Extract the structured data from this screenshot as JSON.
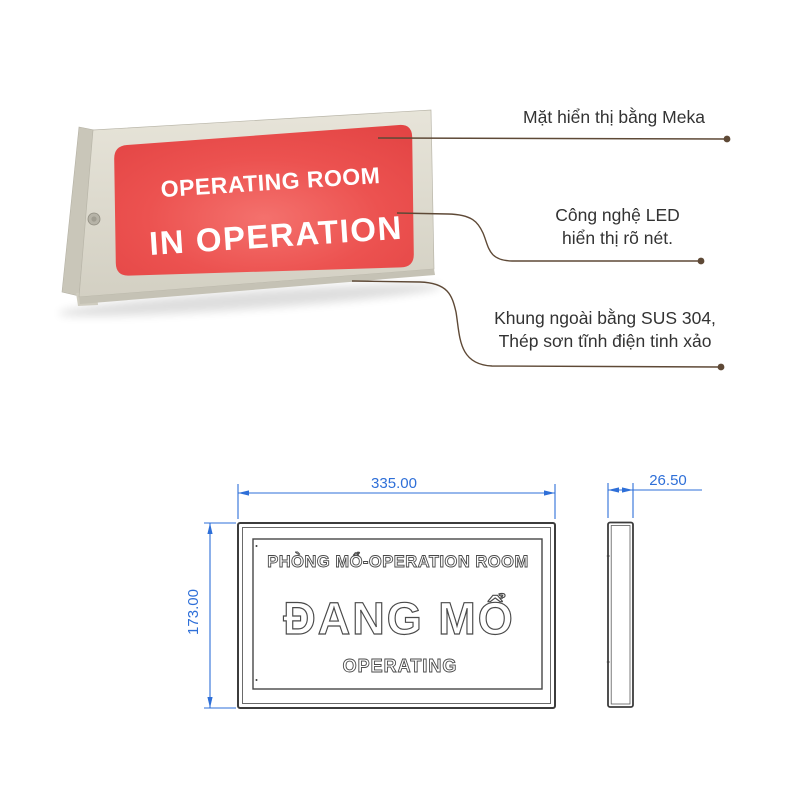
{
  "sign": {
    "display_line1": "OPERATING ROOM",
    "display_line2": "IN OPERATION",
    "colors": {
      "display_red": "#e94b4b",
      "frame_beige": "#dbd7ca",
      "sign_text": "#ffffff",
      "leader_brown": "#5e4936"
    }
  },
  "annotations": [
    {
      "lines": [
        "Mặt hiển thị bằng Meka"
      ]
    },
    {
      "lines": [
        "Công nghệ LED",
        "hiển thị rõ nét."
      ]
    },
    {
      "lines": [
        "Khung ngoài bằng SUS 304,",
        "Thép sơn tĩnh điện tinh xảo"
      ]
    }
  ],
  "drawing": {
    "front_view": {
      "text_top": "PHÒNG MỔ-OPERATION ROOM",
      "text_main": "ĐANG MỔ",
      "text_bottom": "OPERATING",
      "dim_width": "335.00",
      "dim_height": "173.00"
    },
    "side_view": {
      "dim_depth": "26.50"
    },
    "colors": {
      "dimension_blue": "#2e6fd8",
      "outline_gray": "#3c3c3c"
    }
  }
}
